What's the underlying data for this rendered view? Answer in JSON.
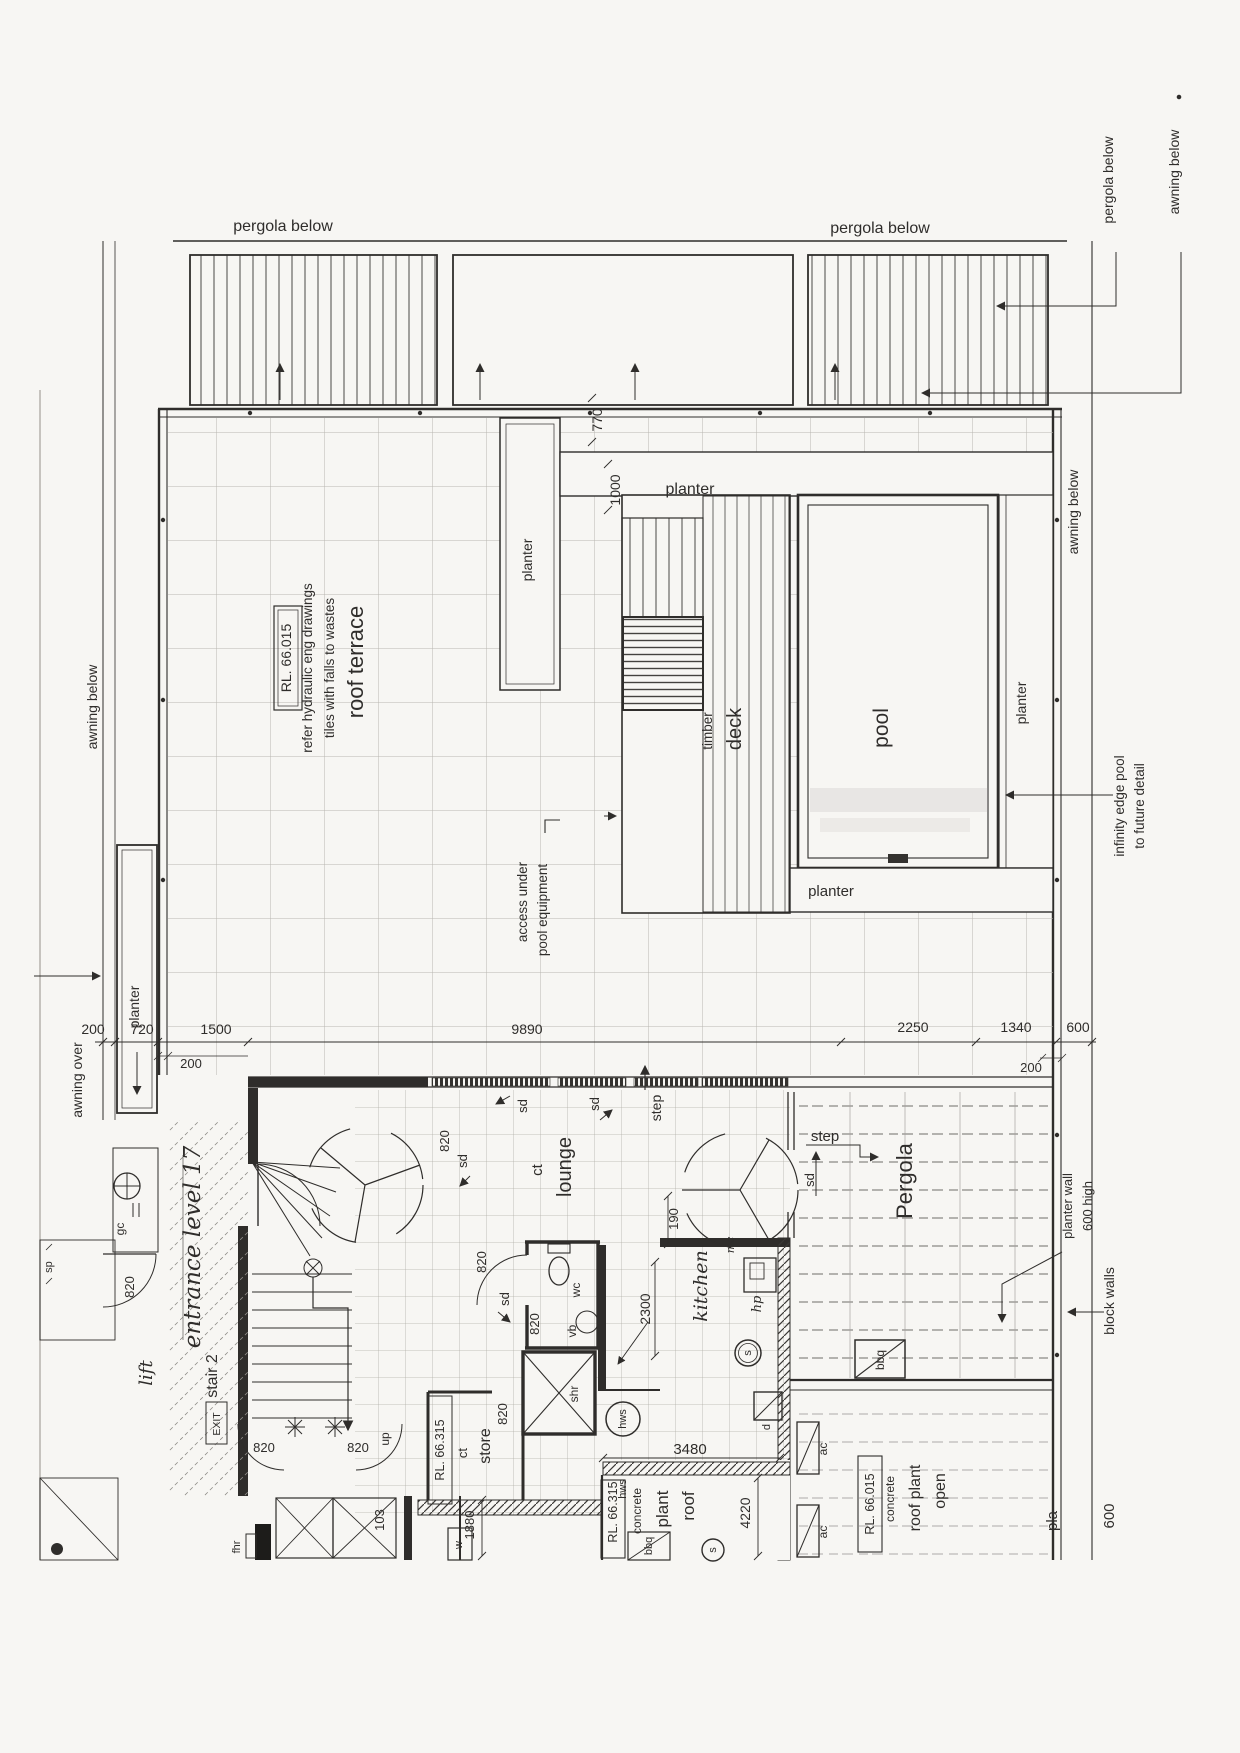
{
  "colors": {
    "ink": "#2f2d2b",
    "paper": "#f7f6f3",
    "grid_light": "#b9b6b0"
  },
  "annotations": {
    "pergola_below": "pergola below",
    "awning_below": "awning below",
    "awning_over": "awning over",
    "planter": "planter",
    "pool_equipment_1": "pool equipment",
    "pool_equipment_2": "access under",
    "infinity_1": "infinity edge pool",
    "infinity_2": "to future detail",
    "planter_wall_1": "planter wall",
    "planter_wall_2": "600 high",
    "block_walls": "block walls",
    "edge_text_1": "pla",
    "edge_text_2": "600"
  },
  "terrace": {
    "title": "roof terrace",
    "note_1": "tiles with falls to wastes",
    "note_2": "refer hydraulic eng drawings"
  },
  "levels": {
    "rl_66015": "RL. 66.015",
    "rl_66315": "RL. 66.315"
  },
  "pool": {
    "label": "pool",
    "deck_1": "timber",
    "deck_2": "deck"
  },
  "rooms": {
    "lounge": "lounge",
    "lounge_finish": "ct",
    "kitchen": "kitchen",
    "pergola": "Pergola",
    "store": "store",
    "store_finish": "ct",
    "stair": "stair 2",
    "level_name": "entrance level 17",
    "lift": "lift",
    "wc": "wc",
    "vb": "vb",
    "shr": "shr",
    "roof_plant_1": "roof",
    "roof_plant_2": "plant",
    "roof_plant_3": "concrete",
    "open_plant_1": "open",
    "open_plant_2": "roof plant",
    "open_plant_3": "concrete"
  },
  "fixtures": {
    "sd": "sd",
    "step": "step",
    "up": "up",
    "exit": "EXIT",
    "hws": "hws",
    "ac": "ac",
    "bbq": "bbq",
    "hp": "hp",
    "s": "s",
    "d": "d",
    "mc": "mc",
    "gc": "gc",
    "sp": "sp",
    "w": "w",
    "fhr": "fhr"
  },
  "dimensions": {
    "d200": "200",
    "d720": "720",
    "d1500": "1500",
    "d9890": "9890",
    "d2250": "2250",
    "d1340": "1340",
    "d600": "600",
    "d770": "770",
    "d1000": "1000",
    "d190": "190",
    "d820": "820",
    "d2300": "2300",
    "d3480": "3480",
    "d4220": "4220",
    "d1880": "1880",
    "d103": "103"
  }
}
